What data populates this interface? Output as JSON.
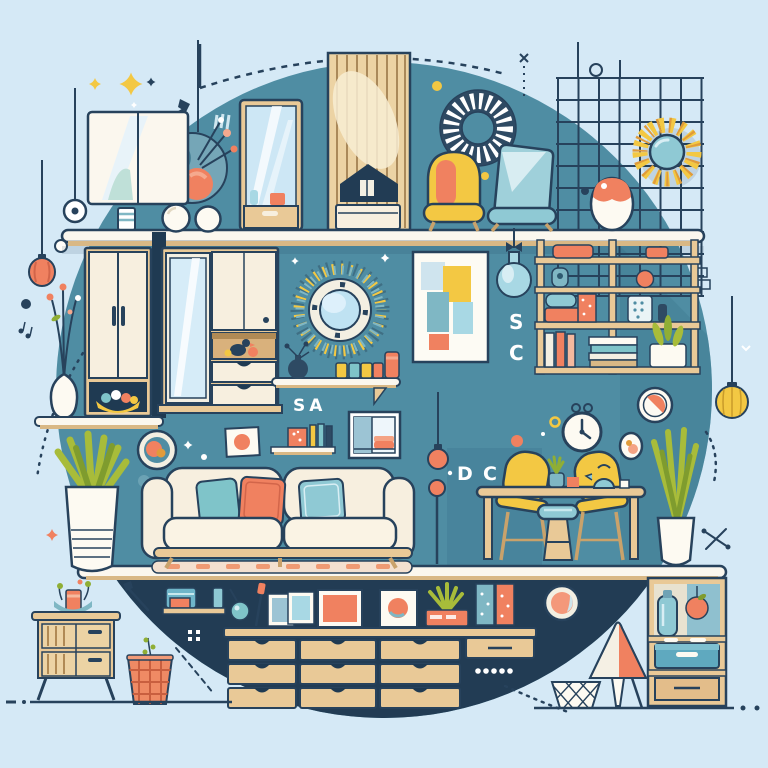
{
  "scene": {
    "title": "Flat-style home furniture and decor collage illustration",
    "letters": {
      "sa": "SA",
      "s": "S",
      "c": "C",
      "d": "D",
      "c2": "C",
      "r": "R"
    }
  },
  "palette": {
    "background": "#d5e9f6",
    "circle_teal": "#4f8da3",
    "teal_shadow": "#447f96",
    "navy": "#223c54",
    "outline": "#27425c",
    "cream": "#f7efdf",
    "wood": "#e9c997",
    "wood_dark": "#c9a26b",
    "coral": "#f08160",
    "aqua": "#8fc9d4",
    "yellow": "#f3c843",
    "offwhite": "#f3efe2",
    "mirror_blue": "#cde7f5",
    "olive": "#a8bc3a"
  },
  "objects": [
    "wall cabinet mirror",
    "hanging terrarium",
    "pendant lamps",
    "full-length mirror",
    "wood slat panel",
    "woven wreath",
    "yellow armchair",
    "teal chair",
    "egg vase",
    "sun mirror",
    "wire grid",
    "wardrobe",
    "mirror cabinet",
    "sunburst mirror",
    "display shelves",
    "abstract art frame",
    "glass pendant light",
    "bookshelf",
    "wall clock",
    "round mirrors",
    "sofa with pillows",
    "area rug",
    "potted plants",
    "dining table",
    "yellow chairs",
    "stool",
    "sideboard with drawers",
    "gallery frames",
    "nightstand",
    "storage basket",
    "floor lamp",
    "waste basket",
    "storage shelf unit",
    "yellow pendant ball"
  ]
}
